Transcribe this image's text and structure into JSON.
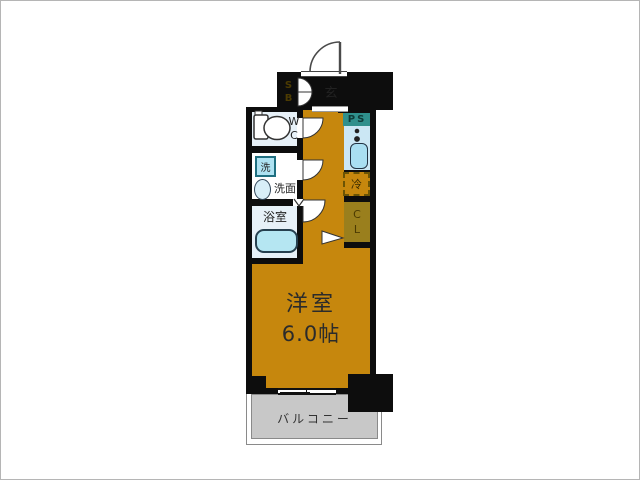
{
  "labels": {
    "entrance": "玄",
    "shoe_box": "S\nB",
    "toilet": "W\nC",
    "pipe_space": "PS",
    "laundry": "洗",
    "washroom": "洗面",
    "bathroom": "浴室",
    "refrigerator": "冷",
    "closet": "C\nL",
    "main_room_name": "洋室",
    "main_room_size": "6.0帖",
    "balcony": "バルコニー"
  },
  "colors": {
    "room_floor": "#c6870d",
    "wall": "#0d0d0d",
    "entrance_floor": "#c4c4c4",
    "storage_fill": "#9a7f1d",
    "storage_text": "#4c3b02",
    "pipe_space_fill": "#2f908c",
    "pipe_space_text": "#0e3b38",
    "kitchen_counter": "#cbe7f4",
    "wet_room": "#e7f1f8",
    "fixture_fill": "#aee2f2",
    "balcony_floor": "#c8c8c8",
    "label_text": "#222222"
  }
}
